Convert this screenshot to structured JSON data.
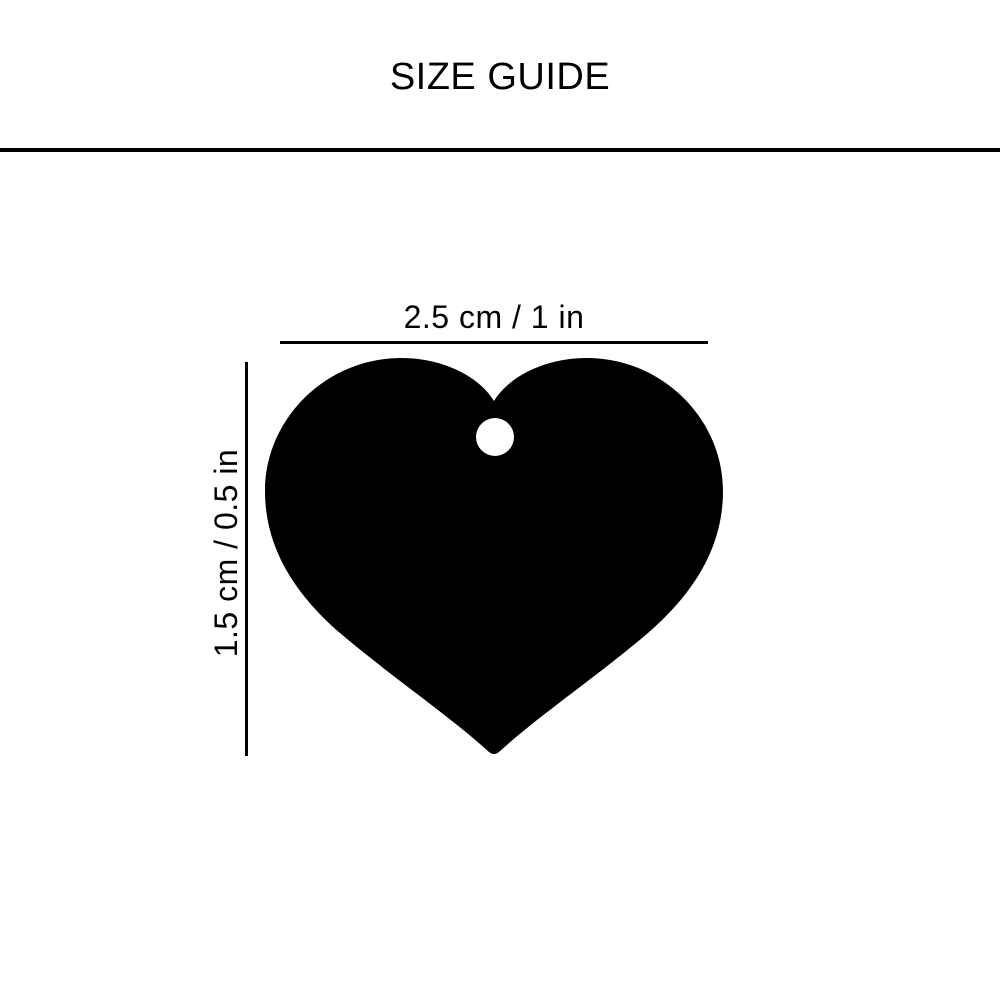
{
  "header": {
    "title": "SIZE GUIDE"
  },
  "diagram": {
    "item": "heart-pet-tag-silhouette",
    "width_label": "2.5 cm / 1 in",
    "height_label": "1.5 cm / 0.5 in",
    "shape_color": "#000000",
    "line_color": "#000000",
    "background_color": "#ffffff"
  }
}
